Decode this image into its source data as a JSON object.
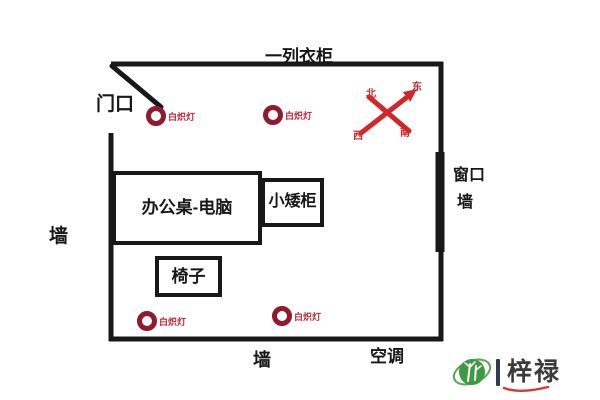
{
  "room": {
    "wardrobe_label": "一列衣柜",
    "door_label": "门口",
    "left_wall_label": "墙",
    "bottom_wall_label": "墙",
    "window_label": "窗口",
    "window_wall_label": "墙",
    "ac_label": "空调"
  },
  "furniture": {
    "desk_label": "办公桌-电脑",
    "cabinet_label": "小矮柜",
    "chair_label": "椅子"
  },
  "lamps": [
    {
      "label": "白炽灯"
    },
    {
      "label": "白炽灯"
    },
    {
      "label": "白炽灯"
    },
    {
      "label": "白炽灯"
    }
  ],
  "compass": {
    "north": "北",
    "east": "东",
    "west": "西",
    "south": "南"
  },
  "watermark": {
    "separator": "|",
    "brand": "梓禄"
  },
  "colors": {
    "wall": "#181818",
    "lamp_ring": "#8e1b2e",
    "lamp_text": "#c22736",
    "compass_red": "#d3262b",
    "watermark_green": "#3e9a43",
    "watermark_text": "#3b3b3b"
  }
}
